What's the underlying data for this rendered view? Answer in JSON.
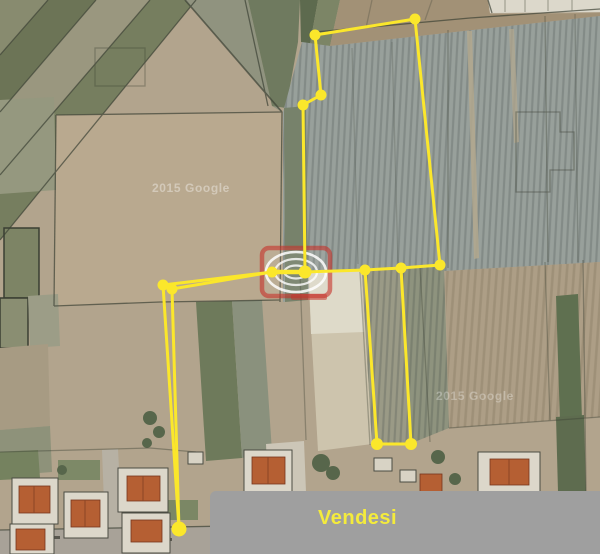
{
  "banner": {
    "label": "Vendesi",
    "background": "#9f9f9f",
    "text_color": "#f4eb3c"
  },
  "watermarks": {
    "left": "2015 Google",
    "right": "2015 Google"
  },
  "logo": {
    "box_color": "rgba(198,50,42,0.6)",
    "ring_color": "rgba(255,255,255,0.85)"
  },
  "overlay": {
    "color": "#fbe72b",
    "line_width": 3,
    "dot_radius": 5.5,
    "dot_radius_overrides": {
      "L": 7.5,
      "E": 6.5,
      "M": 6,
      "N": 6
    },
    "vertices": {
      "A": [
        415,
        19
      ],
      "B": [
        315,
        35
      ],
      "C": [
        321,
        95
      ],
      "D": [
        303,
        105
      ],
      "E": [
        305,
        272
      ],
      "F": [
        365,
        270
      ],
      "G": [
        401,
        268
      ],
      "H": [
        440,
        265
      ],
      "I": [
        272,
        272
      ],
      "J": [
        163,
        285
      ],
      "K": [
        172,
        289
      ],
      "L": [
        179,
        529
      ],
      "M": [
        377,
        444
      ],
      "N": [
        411,
        444
      ]
    },
    "segments": [
      [
        "A",
        "B",
        3
      ],
      [
        "B",
        "C",
        3
      ],
      [
        "C",
        "D",
        3
      ],
      [
        "D",
        "E",
        3
      ],
      [
        "E",
        "I",
        4.5
      ],
      [
        "I",
        "J",
        3
      ],
      [
        "I",
        "K",
        3
      ],
      [
        "J",
        "L",
        3
      ],
      [
        "K",
        "L",
        3
      ],
      [
        "E",
        "F",
        3
      ],
      [
        "F",
        "G",
        3
      ],
      [
        "G",
        "H",
        3
      ],
      [
        "H",
        "A",
        3
      ],
      [
        "F",
        "M",
        3
      ],
      [
        "M",
        "N",
        3
      ],
      [
        "N",
        "G",
        3
      ]
    ]
  }
}
